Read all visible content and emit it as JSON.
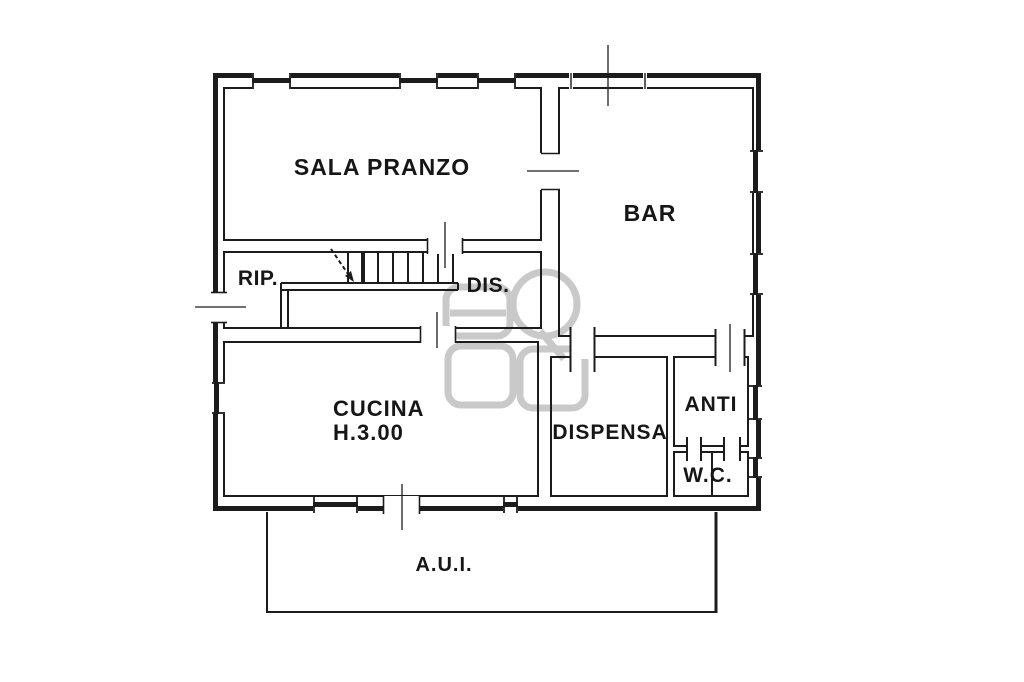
{
  "plan": {
    "type": "floor-plan",
    "colors": {
      "line": "#1c1c1c",
      "watermark": "#c9c9c9",
      "background": "#ffffff"
    },
    "rooms": {
      "sala_pranzo": {
        "label": "SALA PRANZO"
      },
      "bar": {
        "label": "BAR"
      },
      "rip": {
        "label": "RIP."
      },
      "dis": {
        "label": "DIS."
      },
      "cucina": {
        "label": "CUCINA",
        "height_note": "H.3.00"
      },
      "dispensa": {
        "label": "DISPENSA"
      },
      "anti": {
        "label": "ANTI"
      },
      "wc": {
        "label": "W.C."
      },
      "aui": {
        "label": "A.U.I."
      }
    }
  }
}
